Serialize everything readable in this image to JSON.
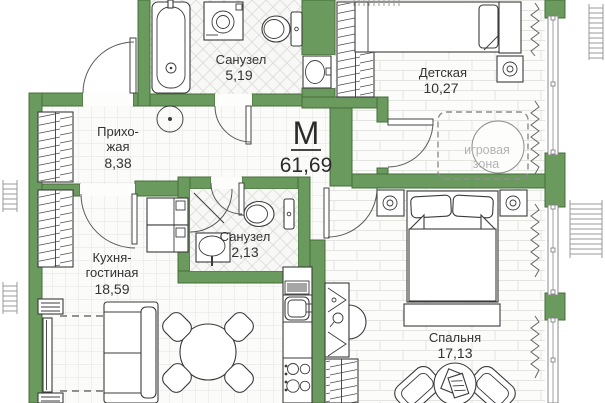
{
  "plan": {
    "unit_label": "М",
    "total_area": "61,69",
    "rooms": {
      "bath1": {
        "name": "Санузел",
        "area": "5,19"
      },
      "kids": {
        "name": "Детская",
        "area": "10,27"
      },
      "hall": {
        "line1": "Прихо-",
        "line2": "жая",
        "area": "8,38"
      },
      "bath2": {
        "name": "Санузел",
        "area": "2,13"
      },
      "kitchen": {
        "line1": "Кухня-",
        "line2": "гостиная",
        "area": "18,59"
      },
      "bedroom": {
        "name": "Спальня",
        "area": "17,13"
      }
    },
    "play_zone": {
      "line1": "игровая",
      "line2": "зона"
    },
    "colors": {
      "wall_green": "#6a9a5d",
      "wall_outline": "#456f3a",
      "label_text": "#333333",
      "play_zone_text": "#b3b3b3",
      "floor_line": "#e3e3e1"
    }
  }
}
